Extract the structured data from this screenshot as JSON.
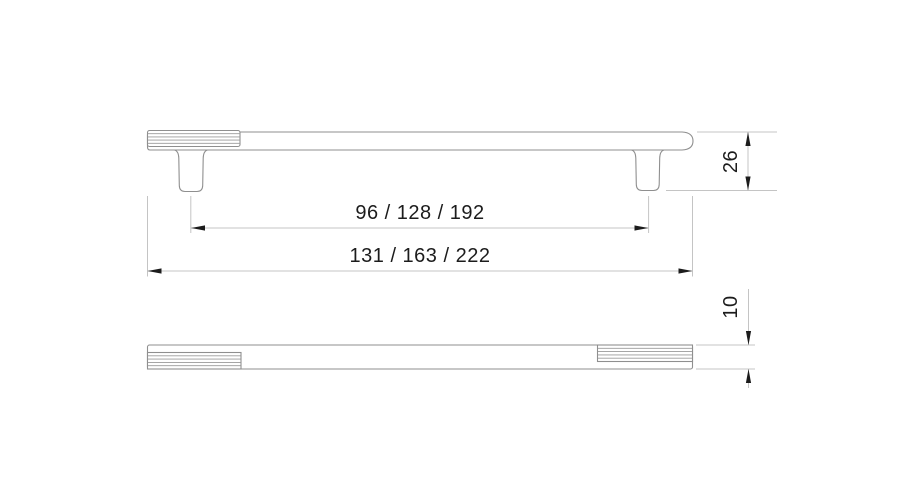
{
  "drawing": {
    "title": "Furniture handle dimension drawing",
    "views": [
      {
        "id": "front-view",
        "description": "Side elevation: bar handle with knurled left end and two mounting legs"
      },
      {
        "id": "plan-view",
        "description": "Top view: handle bar with knurled left and right ends"
      }
    ],
    "dimensions": [
      {
        "id": "hole-spacing",
        "label": "96 / 128 / 192",
        "orientation": "horizontal"
      },
      {
        "id": "overall-length",
        "label": "131 / 163 / 222",
        "orientation": "horizontal"
      },
      {
        "id": "handle-height",
        "label": "26",
        "orientation": "vertical"
      },
      {
        "id": "bar-thickness",
        "label": "10",
        "orientation": "vertical"
      }
    ],
    "colors": {
      "outline": "#8f8f8f",
      "knurl_line": "#9a9a9a",
      "dimension_line": "#c4c4c4",
      "arrow": "#1c1c1c",
      "text": "#1c1c1c",
      "background": "#ffffff"
    }
  }
}
